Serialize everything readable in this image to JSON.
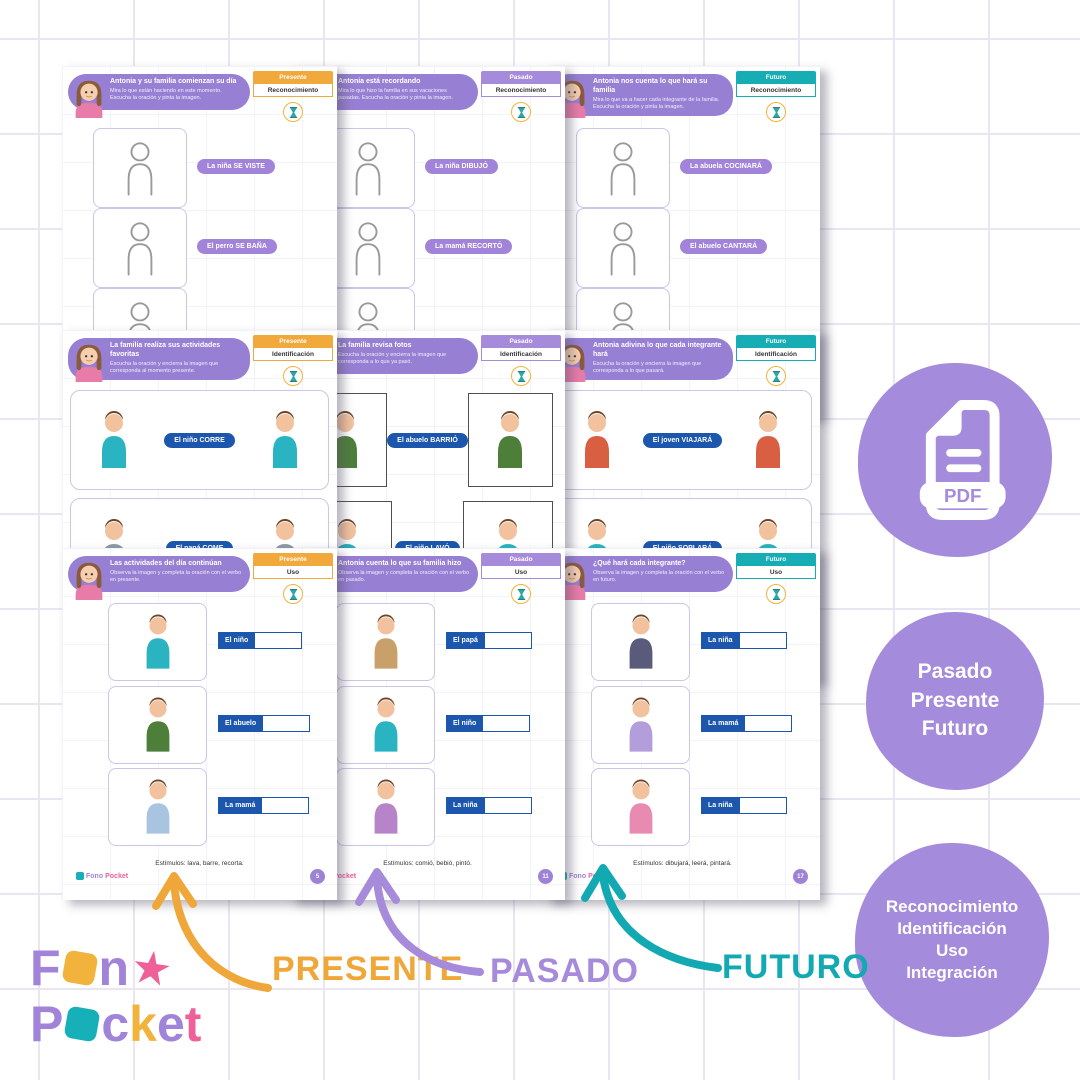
{
  "brand": {
    "part1": "Fono",
    "part2": "Pocket"
  },
  "colors": {
    "purple": "#a183d9",
    "yellow": "#f2b33c",
    "pink": "#ef5f98",
    "teal": "#17b0b8",
    "blue": "#1c57ad"
  },
  "worksheets": [
    {
      "tense": "Presente",
      "level": "Reconocimiento",
      "title": "Antonia y su familia comienzan su día",
      "subtitle": "Mira lo que están haciendo en este momento. Escucha la oración y pinta la imagen.",
      "items": [
        {
          "label": "La niña SE VISTE"
        },
        {
          "label": "El perro SE BAÑA"
        }
      ]
    },
    {
      "tense": "Pasado",
      "level": "Reconocimiento",
      "title": "Antonia está recordando",
      "subtitle": "Mira lo que hizo la familia en sus vacaciones pasadas. Escucha la oración y pinta la imagen.",
      "items": [
        {
          "label": "La niña DIBUJÓ"
        },
        {
          "label": "La mamá RECORTÓ"
        }
      ]
    },
    {
      "tense": "Futuro",
      "level": "Reconocimiento",
      "title": "Antonia nos cuenta lo que hará su familia",
      "subtitle": "Mira lo que va a hacer cada integrante de la familia. Escucha la oración y pinta la imagen.",
      "items": [
        {
          "label": "La abuela COCINARÁ"
        },
        {
          "label": "El abuelo CANTARÁ"
        }
      ]
    },
    {
      "tense": "Presente",
      "level": "Identificación",
      "title": "La familia realiza sus actividades favoritas",
      "subtitle": "Escucha la oración y encierra la imagen que corresponda al momento presente.",
      "items": [
        {
          "label": "El niño CORRE"
        },
        {
          "label": "El papá COME"
        }
      ]
    },
    {
      "tense": "Pasado",
      "level": "Identificación",
      "title": "La familia revisa fotos",
      "subtitle": "Escucha la oración y encierra la imagen que corresponda a lo que ya pasó.",
      "items": [
        {
          "label": "El abuelo BARRIÓ"
        },
        {
          "label": "El niño LAVÓ"
        }
      ]
    },
    {
      "tense": "Futuro",
      "level": "Identificación",
      "title": "Antonia adivina lo que cada integrante hará",
      "subtitle": "Escucha la oración y encierra la imagen que corresponda a lo que pasará.",
      "items": [
        {
          "label": "El joven VIAJARÁ"
        },
        {
          "label": "El niño SOPLARÁ"
        }
      ]
    },
    {
      "tense": "Presente",
      "level": "Uso",
      "title": "Las actividades del día continúan",
      "subtitle": "Observa la imagen y completa la oración con el verbo en presente.",
      "items": [
        {
          "label": "El niño"
        },
        {
          "label": "El abuelo"
        },
        {
          "label": "La mamá"
        }
      ],
      "stimuli": "Estímulos: lava, barre, recorta.",
      "page_number": "5"
    },
    {
      "tense": "Pasado",
      "level": "Uso",
      "title": "Antonia cuenta lo que su familia hizo",
      "subtitle": "Observa la imagen y completa la oración con el verbo en pasado.",
      "items": [
        {
          "label": "El papá"
        },
        {
          "label": "El niño"
        },
        {
          "label": "La niña"
        }
      ],
      "stimuli": "Estímulos: comió, bebió, pintó.",
      "page_number": "11"
    },
    {
      "tense": "Futuro",
      "level": "Uso",
      "title": "¿Qué hará cada integrante?",
      "subtitle": "Observa la imagen y completa la oración con el verbo en futuro.",
      "items": [
        {
          "label": "La niña"
        },
        {
          "label": "La mamá"
        },
        {
          "label": "La niña"
        }
      ],
      "stimuli": "Estímulos: dibujará, leerá, pintará.",
      "page_number": "17"
    }
  ],
  "badges": {
    "pdf_label": "PDF",
    "tenses": [
      "Pasado",
      "Presente",
      "Futuro"
    ],
    "levels": [
      "Reconocimiento",
      "Identificación",
      "Uso",
      "Integración"
    ]
  },
  "bottom_labels": [
    {
      "text": "PRESENTE",
      "color": "#f0a73a"
    },
    {
      "text": "PASADO",
      "color": "#a78bdb"
    },
    {
      "text": "FUTURO",
      "color": "#12a9b2"
    }
  ],
  "logo": {
    "line1": [
      "F",
      "n",
      "★"
    ],
    "line2": [
      "P",
      "c",
      "k",
      "e",
      "t"
    ]
  }
}
